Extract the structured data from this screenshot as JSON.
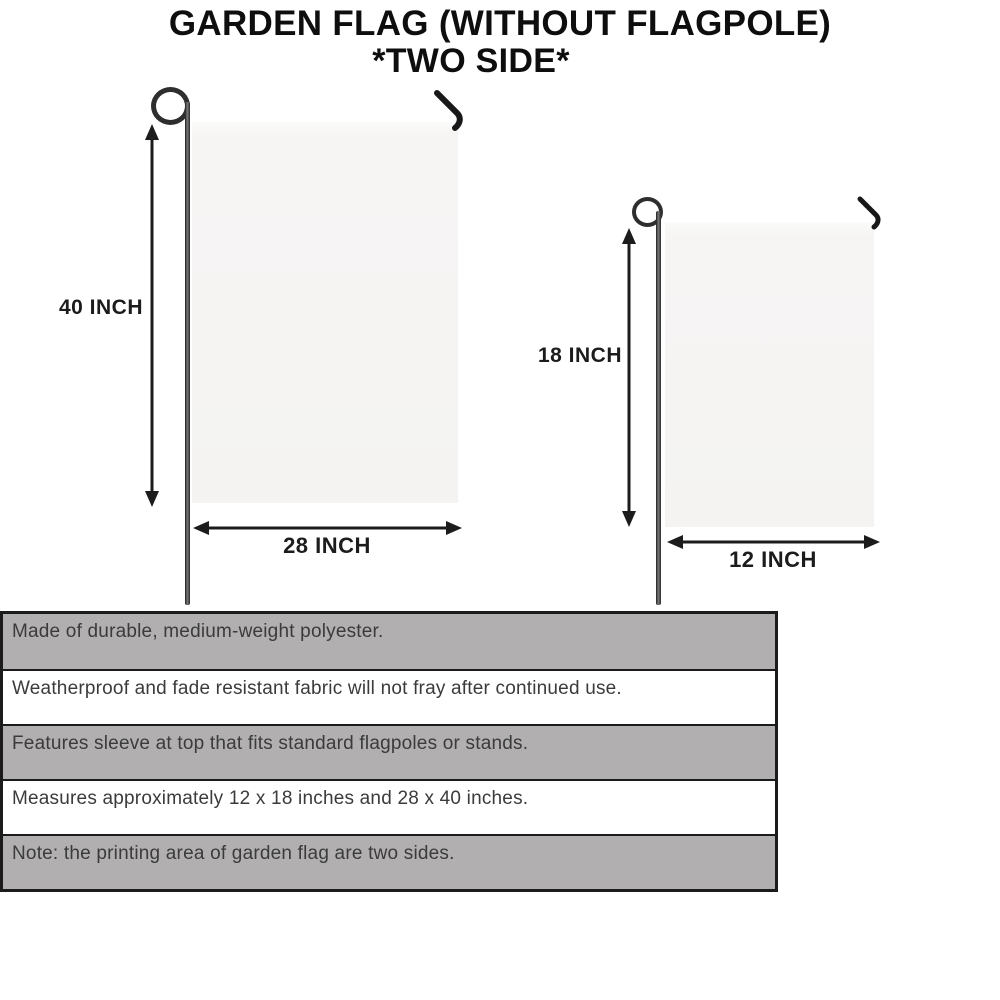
{
  "title": {
    "line1": "GARDEN FLAG (WITHOUT FLAGPOLE)",
    "line2": "*TWO SIDE*"
  },
  "flags": {
    "large": {
      "height_label": "40 INCH",
      "width_label": "28 INCH"
    },
    "small": {
      "height_label": "18 INCH",
      "width_label": "12 INCH"
    }
  },
  "features": [
    "Made of durable, medium-weight polyester.",
    "Weatherproof and fade resistant fabric will not fray after continued use.",
    "Features sleeve at top that fits standard flagpoles or stands.",
    "Measures approximately 12 x 18 inches and 28 x 40 inches.",
    "Note: the printing area of garden flag are two sides."
  ],
  "icons": {
    "flagpole_loop": "circle-outline",
    "flagpole_hook": "bent-wire-angle",
    "dimension_arrow": "double-headed-arrow"
  },
  "colors": {
    "table_row_gray": "#b1afaf",
    "table_border": "#1b1b1b",
    "flag_fill": "#f5f4f3",
    "pole_metal": "#2e2e2e",
    "dimension_text": "#1c1c1c",
    "feature_text": "#3b3b3b"
  }
}
